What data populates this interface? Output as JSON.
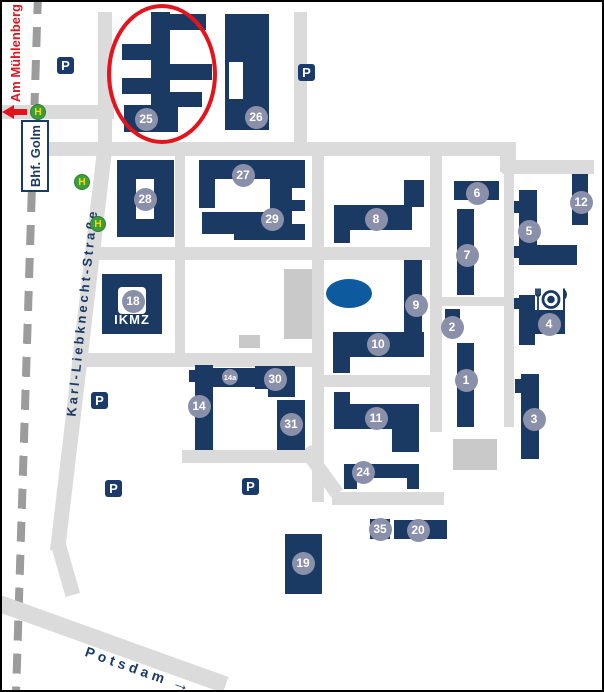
{
  "colors": {
    "building": "#1a3a63",
    "badge_circle": "#8b90aa",
    "road": "#dbdbdb",
    "railway": "#9c9c9c",
    "pond": "#0e5a9e",
    "highlight_red": "#e3141c",
    "bus_stop_green": "#3f9e3c",
    "bus_stop_letter": "#ffd800",
    "navy_text": "#1a3a66",
    "parking_bg": "#1a3a6b",
    "gray_building": "#c9c9c9"
  },
  "streets": {
    "karl_liebknecht": "Karl-Liebknecht-Straße",
    "am_muehlenberg": "Am Mühlenberg",
    "potsdam_direction": "Potsdam",
    "station_sign": "Bhf. Golm"
  },
  "labels": {
    "ikmz": "IKMZ",
    "parking": "P",
    "bus_stop": "H",
    "potsdam_arrow": "→"
  },
  "highlighted_building": "25",
  "badges": [
    {
      "label": "25",
      "x": 144,
      "y": 117
    },
    {
      "label": "26",
      "x": 254,
      "y": 115
    },
    {
      "label": "27",
      "x": 241,
      "y": 173
    },
    {
      "label": "28",
      "x": 143,
      "y": 197
    },
    {
      "label": "29",
      "x": 270,
      "y": 217
    },
    {
      "label": "18",
      "x": 131,
      "y": 299
    },
    {
      "label": "8",
      "x": 374,
      "y": 217
    },
    {
      "label": "6",
      "x": 475,
      "y": 191
    },
    {
      "label": "7",
      "x": 465,
      "y": 253
    },
    {
      "label": "5",
      "x": 527,
      "y": 229
    },
    {
      "label": "12",
      "x": 579,
      "y": 200
    },
    {
      "label": "4",
      "x": 547,
      "y": 322
    },
    {
      "label": "2",
      "x": 450,
      "y": 325
    },
    {
      "label": "9",
      "x": 414,
      "y": 303
    },
    {
      "label": "10",
      "x": 376,
      "y": 342
    },
    {
      "label": "1",
      "x": 464,
      "y": 378
    },
    {
      "label": "3",
      "x": 532,
      "y": 417
    },
    {
      "label": "11",
      "x": 374,
      "y": 416
    },
    {
      "label": "14",
      "x": 197,
      "y": 404
    },
    {
      "label": "14a",
      "x": 228,
      "y": 375,
      "small": true
    },
    {
      "label": "30",
      "x": 273,
      "y": 377
    },
    {
      "label": "31",
      "x": 289,
      "y": 422
    },
    {
      "label": "24",
      "x": 361,
      "y": 470
    },
    {
      "label": "35",
      "x": 378,
      "y": 527
    },
    {
      "label": "20",
      "x": 416,
      "y": 528
    },
    {
      "label": "19",
      "x": 301,
      "y": 561
    }
  ],
  "parking_signs": [
    {
      "x": 63,
      "y": 63
    },
    {
      "x": 304,
      "y": 70
    },
    {
      "x": 97,
      "y": 398
    },
    {
      "x": 111,
      "y": 486
    },
    {
      "x": 248,
      "y": 484
    }
  ],
  "bus_stops": [
    {
      "x": 36,
      "y": 110
    },
    {
      "x": 80,
      "y": 180
    },
    {
      "x": 96,
      "y": 222
    }
  ]
}
